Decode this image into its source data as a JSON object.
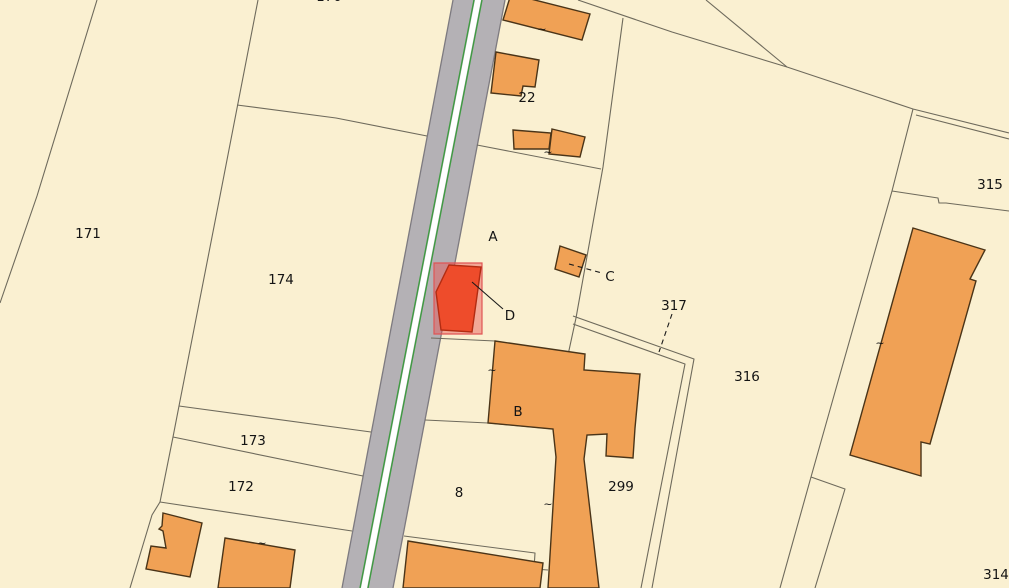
{
  "canvas": {
    "width": 1009,
    "height": 588
  },
  "colors": {
    "background": "#faf0d1",
    "parcel_line": "#6e6a5c",
    "road_fill": "#b4b1b5",
    "road_casing": "#7d7a80",
    "road_stripe": "#ffffff",
    "road_green": "#3f9b42",
    "building_fill": "#f0a155",
    "building_stroke": "#4a3418",
    "selection_area_fill": "rgba(232,80,80,0.45)",
    "selection_area_stroke": "#e05555",
    "selection_building_fill": "#ee4c2b",
    "selection_building_stroke": "#b22c12",
    "label_color": "#141414",
    "leader_color": "#1a1a1a"
  },
  "map": {
    "road": {
      "surface": [
        [
          453,
          0
        ],
        [
          505,
          0
        ],
        [
          393,
          588
        ],
        [
          342,
          588
        ]
      ],
      "casings": [
        [
          [
            453,
            0
          ],
          [
            342,
            588
          ]
        ],
        [
          [
            505,
            0
          ],
          [
            393,
            588
          ]
        ]
      ],
      "stripe": [
        [
          475,
          0
        ],
        [
          481,
          0
        ],
        [
          367,
          588
        ],
        [
          361,
          588
        ]
      ],
      "green_lines": [
        [
          [
            474,
            0
          ],
          [
            360,
            588
          ]
        ],
        [
          [
            482,
            0
          ],
          [
            368,
            588
          ]
        ]
      ]
    },
    "parcel_lines": [
      {
        "name": "boundary-left",
        "points": [
          [
            97,
            0
          ],
          [
            37,
            196
          ],
          [
            0,
            303
          ]
        ]
      },
      {
        "name": "boundary-174-west",
        "points": [
          [
            258,
            0
          ],
          [
            220,
            196
          ],
          [
            179,
            406
          ],
          [
            173,
            437
          ],
          [
            160,
            502
          ],
          [
            152,
            515
          ],
          [
            130,
            588
          ]
        ]
      },
      {
        "name": "boundary-174-north",
        "points": [
          [
            237,
            105
          ],
          [
            336,
            118
          ],
          [
            427,
            136
          ]
        ]
      },
      {
        "name": "boundary-173-north",
        "points": [
          [
            179,
            406
          ],
          [
            371,
            432
          ]
        ]
      },
      {
        "name": "boundary-173-south",
        "points": [
          [
            173,
            437
          ],
          [
            363,
            476
          ]
        ]
      },
      {
        "name": "boundary-172-south",
        "points": [
          [
            160,
            502
          ],
          [
            352,
            531
          ]
        ]
      },
      {
        "name": "boundary-top-right-a",
        "points": [
          [
            706,
            0
          ],
          [
            787,
            67
          ]
        ]
      },
      {
        "name": "boundary-top-right-b",
        "points": [
          [
            578,
            0
          ],
          [
            672,
            32
          ],
          [
            787,
            67
          ],
          [
            913,
            109
          ]
        ]
      },
      {
        "name": "boundary-315-path-1",
        "points": [
          [
            913,
            109
          ],
          [
            1009,
            133
          ]
        ]
      },
      {
        "name": "boundary-315-path-2",
        "points": [
          [
            916,
            115
          ],
          [
            1009,
            139
          ]
        ]
      },
      {
        "name": "boundary-316-east",
        "points": [
          [
            913,
            109
          ],
          [
            892,
            191
          ],
          [
            835,
            392
          ],
          [
            811,
            477
          ]
        ]
      },
      {
        "name": "boundary-315-314",
        "points": [
          [
            892,
            191
          ],
          [
            938,
            198
          ],
          [
            939,
            203
          ],
          [
            946,
            203
          ],
          [
            1009,
            211
          ]
        ]
      },
      {
        "name": "boundary-22-east",
        "points": [
          [
            623,
            18
          ],
          [
            603,
            167
          ],
          [
            576,
            318
          ],
          [
            568,
            355
          ]
        ]
      },
      {
        "name": "boundary-a-north",
        "points": [
          [
            477,
            145
          ],
          [
            601,
            169
          ]
        ]
      },
      {
        "name": "boundary-a-south",
        "points": [
          [
            431,
            338
          ],
          [
            495,
            341
          ]
        ]
      },
      {
        "name": "boundary-8-north",
        "points": [
          [
            425,
            420
          ],
          [
            488,
            423
          ],
          [
            553,
            429
          ]
        ]
      },
      {
        "name": "boundary-8-south",
        "points": [
          [
            404,
            536
          ],
          [
            535,
            553
          ],
          [
            534,
            569
          ],
          [
            548,
            570
          ]
        ]
      },
      {
        "name": "path-317-edge-1",
        "points": [
          [
            573,
            316
          ],
          [
            694,
            359
          ],
          [
            652,
            588
          ]
        ]
      },
      {
        "name": "path-317-edge-2",
        "points": [
          [
            573,
            324
          ],
          [
            685,
            364
          ],
          [
            641,
            588
          ]
        ]
      },
      {
        "name": "wedge-314-edge-1",
        "points": [
          [
            811,
            477
          ],
          [
            780,
            588
          ]
        ]
      },
      {
        "name": "wedge-314-edge-2",
        "points": [
          [
            811,
            477
          ],
          [
            845,
            489
          ],
          [
            815,
            588
          ]
        ]
      }
    ],
    "buildings": [
      {
        "name": "building-top",
        "points": [
          [
            511,
            -6
          ],
          [
            590,
            14
          ],
          [
            582,
            40
          ],
          [
            503,
            20
          ]
        ]
      },
      {
        "name": "building-22",
        "points": [
          [
            496,
            52
          ],
          [
            539,
            60
          ],
          [
            535,
            87
          ],
          [
            523,
            86
          ],
          [
            521,
            96
          ],
          [
            491,
            93
          ]
        ]
      },
      {
        "name": "building-row-left",
        "points": [
          [
            513,
            130
          ],
          [
            551,
            133
          ],
          [
            549,
            149
          ],
          [
            514,
            149
          ]
        ]
      },
      {
        "name": "building-row-right",
        "points": [
          [
            552,
            129
          ],
          [
            585,
            137
          ],
          [
            580,
            157
          ],
          [
            549,
            154
          ]
        ]
      },
      {
        "name": "building-c",
        "points": [
          [
            560,
            246
          ],
          [
            586,
            255
          ],
          [
            579,
            277
          ],
          [
            555,
            269
          ]
        ]
      },
      {
        "name": "building-b",
        "points": [
          [
            495,
            341
          ],
          [
            585,
            354
          ],
          [
            584,
            370
          ],
          [
            640,
            374
          ],
          [
            635,
            428
          ],
          [
            633,
            458
          ],
          [
            606,
            456
          ],
          [
            607,
            434
          ],
          [
            587,
            435
          ],
          [
            584,
            459
          ],
          [
            599,
            588
          ],
          [
            548,
            588
          ],
          [
            556,
            457
          ],
          [
            553,
            429
          ],
          [
            488,
            423
          ]
        ]
      },
      {
        "name": "building-l-shape",
        "points": [
          [
            163,
            513
          ],
          [
            202,
            523
          ],
          [
            190,
            577
          ],
          [
            146,
            569
          ],
          [
            151,
            546
          ],
          [
            166,
            548
          ],
          [
            163,
            531
          ],
          [
            159,
            529
          ],
          [
            162,
            526
          ]
        ]
      },
      {
        "name": "building-bottom-left",
        "points": [
          [
            225,
            538
          ],
          [
            295,
            550
          ],
          [
            290,
            588
          ],
          [
            218,
            588
          ]
        ]
      },
      {
        "name": "building-bottom-mid",
        "points": [
          [
            408,
            541
          ],
          [
            543,
            563
          ],
          [
            540,
            588
          ],
          [
            403,
            588
          ]
        ]
      },
      {
        "name": "building-315",
        "points": [
          [
            913,
            228
          ],
          [
            985,
            250
          ],
          [
            970,
            279
          ],
          [
            976,
            281
          ],
          [
            930,
            444
          ],
          [
            921,
            442
          ],
          [
            921,
            476
          ],
          [
            850,
            455
          ]
        ]
      }
    ],
    "selection": {
      "area": [
        [
          434,
          263
        ],
        [
          482,
          263
        ],
        [
          482,
          334
        ],
        [
          434,
          334
        ]
      ],
      "building": [
        [
          449,
          265
        ],
        [
          481,
          267
        ],
        [
          472,
          332
        ],
        [
          441,
          330
        ],
        [
          436,
          292
        ]
      ]
    },
    "leaders": [
      {
        "name": "leader-d",
        "from": [
          472,
          282
        ],
        "to": [
          503,
          309
        ],
        "dashed": false
      },
      {
        "name": "leader-c",
        "from": [
          569,
          264
        ],
        "to": [
          602,
          273
        ],
        "dashed": true
      },
      {
        "name": "leader-317",
        "from": [
          672,
          314
        ],
        "to": [
          659,
          352
        ],
        "dashed": true
      }
    ],
    "ticks": [
      [
        542,
        29
      ],
      [
        548,
        152
      ],
      [
        492,
        370
      ],
      [
        548,
        504
      ],
      [
        262,
        543
      ],
      [
        880,
        343
      ]
    ],
    "labels": [
      {
        "name": "parcel-label-171",
        "text": "171",
        "x": 88,
        "y": 234
      },
      {
        "name": "parcel-label-174",
        "text": "174",
        "x": 281,
        "y": 280
      },
      {
        "name": "parcel-label-173",
        "text": "173",
        "x": 253,
        "y": 441
      },
      {
        "name": "parcel-label-172",
        "text": "172",
        "x": 241,
        "y": 487
      },
      {
        "name": "parcel-label-8",
        "text": "8",
        "x": 459,
        "y": 493
      },
      {
        "name": "parcel-label-22",
        "text": "22",
        "x": 527,
        "y": 98
      },
      {
        "name": "parcel-label-299",
        "text": "299",
        "x": 621,
        "y": 487
      },
      {
        "name": "parcel-label-316",
        "text": "316",
        "x": 747,
        "y": 377
      },
      {
        "name": "parcel-label-317",
        "text": "317",
        "x": 674,
        "y": 306
      },
      {
        "name": "parcel-label-315",
        "text": "315",
        "x": 990,
        "y": 185
      },
      {
        "name": "parcel-label-314",
        "text": "314",
        "x": 996,
        "y": 575
      },
      {
        "name": "parcel-label-top-partial",
        "text": "170",
        "x": 329,
        "y": -3
      },
      {
        "name": "marker-label-a",
        "text": "A",
        "x": 493,
        "y": 237
      },
      {
        "name": "marker-label-b",
        "text": "B",
        "x": 518,
        "y": 412
      },
      {
        "name": "marker-label-c",
        "text": "C",
        "x": 610,
        "y": 277
      },
      {
        "name": "marker-label-d",
        "text": "D",
        "x": 510,
        "y": 316
      }
    ]
  }
}
